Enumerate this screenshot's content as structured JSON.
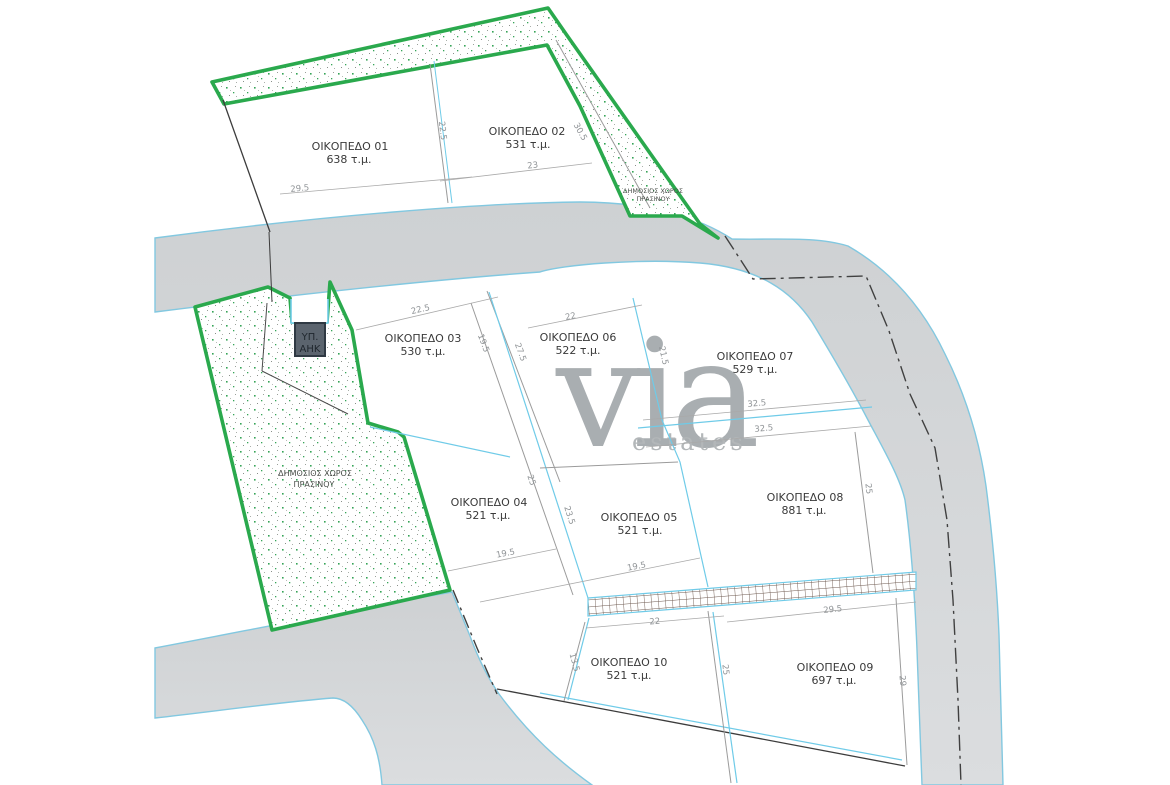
{
  "watermark": {
    "brand": "via",
    "suffix": "estates"
  },
  "legend": {
    "green_label_1": "ΔΗΜΟΣΙΟΣ ΧΩΡΟΣ",
    "green_label_2": "ΠΡΑΣΙΝΟΥ",
    "substation_1": "ΥΠ.",
    "substation_2": "ΑΗΚ"
  },
  "plots": [
    {
      "name": "ΟΙΚΟΠΕΔΟ 01",
      "area": "638 τ.μ."
    },
    {
      "name": "ΟΙΚΟΠΕΔΟ 02",
      "area": "531 τ.μ."
    },
    {
      "name": "ΟΙΚΟΠΕΔΟ 03",
      "area": "530 τ.μ."
    },
    {
      "name": "ΟΙΚΟΠΕΔΟ 04",
      "area": "521 τ.μ."
    },
    {
      "name": "ΟΙΚΟΠΕΔΟ 05",
      "area": "521 τ.μ."
    },
    {
      "name": "ΟΙΚΟΠΕΔΟ 06",
      "area": "522 τ.μ."
    },
    {
      "name": "ΟΙΚΟΠΕΔΟ 07",
      "area": "529 τ.μ."
    },
    {
      "name": "ΟΙΚΟΠΕΔΟ 08",
      "area": "881 τ.μ."
    },
    {
      "name": "ΟΙΚΟΠΕΔΟ 09",
      "area": "697 τ.μ."
    },
    {
      "name": "ΟΙΚΟΠΕΔΟ 10",
      "area": "521 τ.μ."
    }
  ],
  "dims": [
    "29.5",
    "22.5",
    "23",
    "30.5",
    "22.5",
    "19.5",
    "27.5",
    "22",
    "21.5",
    "32.5",
    "32.5",
    "25",
    "19.5",
    "25",
    "23.5",
    "19.5",
    "22",
    "29.5",
    "13.5",
    "25",
    "29"
  ],
  "colors": {
    "green_border": "#2aa94d",
    "cyan_line": "#6fcbe8",
    "road_fill": "#d3d6d8",
    "gray_line": "#9b9b9b",
    "dim_text": "#8f9396",
    "label_text": "#3a3a3a",
    "watermark": "#a9aeb1",
    "checker_line": "#6e5a50",
    "substation_fill": "#5b646e",
    "boundary_dark": "#3c3c3c"
  }
}
